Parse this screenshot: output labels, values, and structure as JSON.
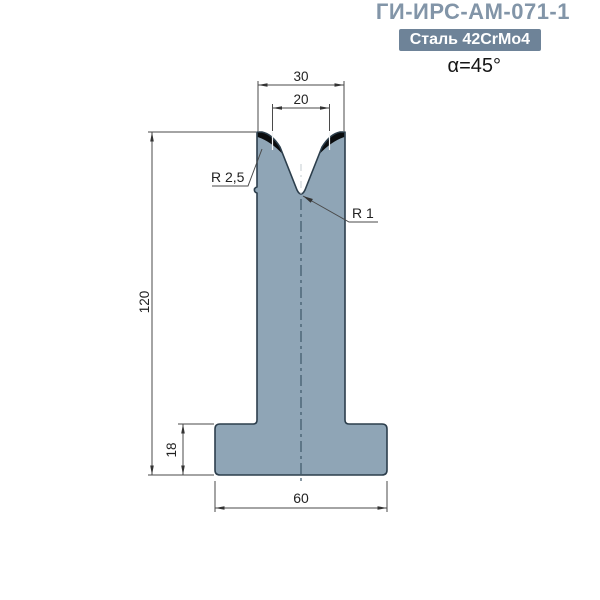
{
  "header": {
    "title": "ГИ-ИРС-АМ-071-1",
    "material_badge": "Сталь 42CrMo4",
    "angle_label": "α=45°"
  },
  "drawing": {
    "dim_top_width": "30",
    "dim_v_opening": "20",
    "dim_total_height": "120",
    "dim_base_height": "18",
    "dim_base_width": "60",
    "label_shoulder_radius": "R 2,5",
    "label_tip_radius": "R 1"
  },
  "colors": {
    "title_text": "#8295a8",
    "badge_bg": "#6e8398",
    "badge_text": "#ffffff",
    "die_body": "#8fa5b6",
    "die_outline": "#2c3e4c",
    "hardened_zone": "#0a0c0e",
    "centerline": "#3d5868",
    "dimension_lines": "#4a4a4a",
    "dimension_text": "#222222"
  }
}
